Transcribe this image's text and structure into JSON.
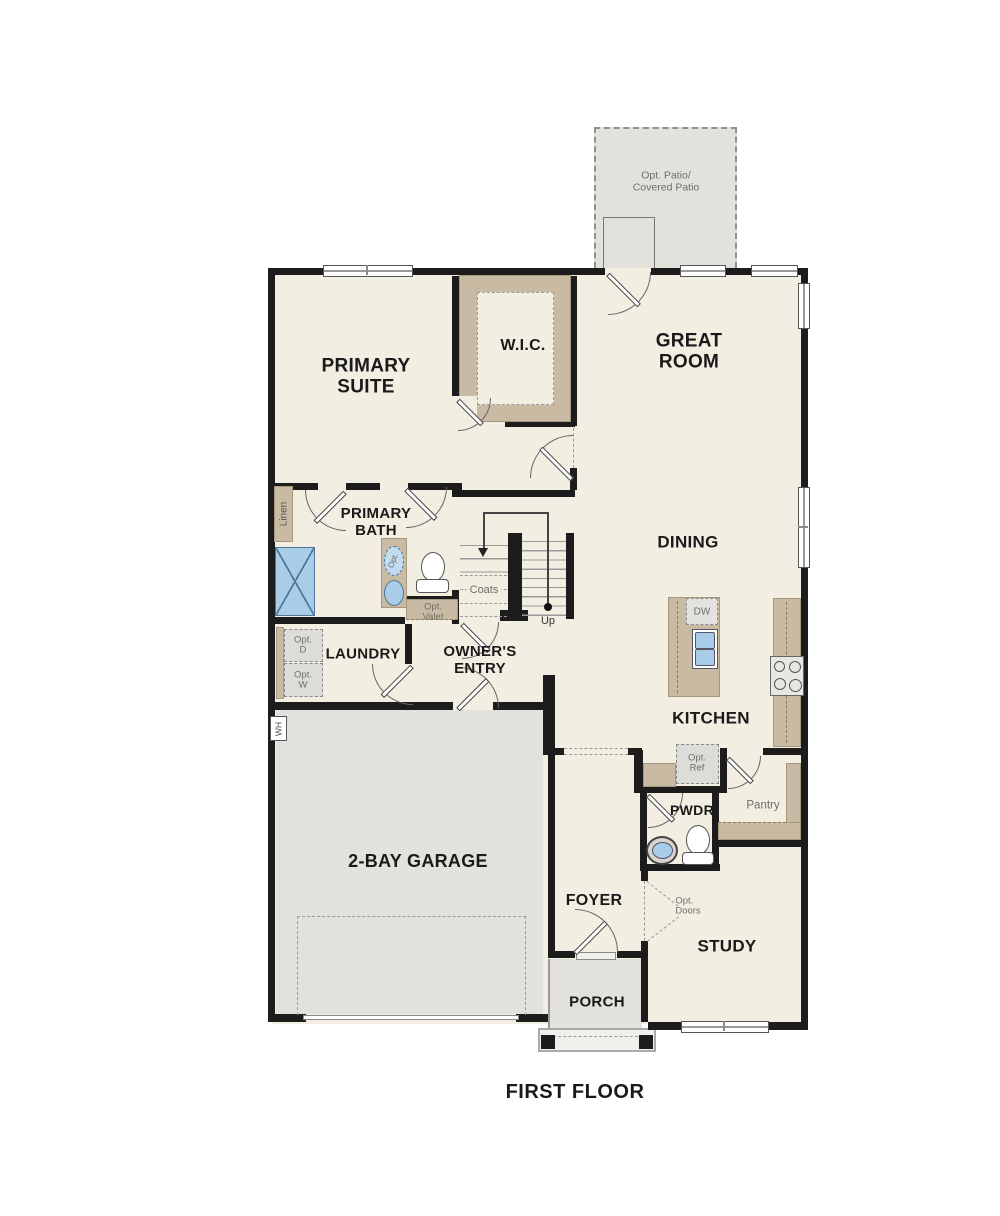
{
  "title": "FIRST FLOOR",
  "rooms": {
    "patio": "Opt. Patio/\nCovered Patio",
    "primary_suite": "PRIMARY\nSUITE",
    "wic": "W.I.C.",
    "great_room": "GREAT\nROOM",
    "dining": "DINING",
    "kitchen": "KITCHEN",
    "primary_bath": "PRIMARY\nBATH",
    "laundry": "LAUNDRY",
    "owners_entry": "OWNER'S\nENTRY",
    "garage": "2-BAY GARAGE",
    "pwdr": "PWDR",
    "pantry": "Pantry",
    "foyer": "FOYER",
    "study": "STUDY",
    "porch": "PORCH"
  },
  "annotations": {
    "linen": "Linen",
    "coats": "Coats",
    "up": "Up",
    "opt_valet": "Opt.\nValet",
    "opt_d": "Opt.\nD",
    "opt_w": "Opt.\nW",
    "opt_ref": "Opt.\nRef",
    "opt_doors": "Opt.\nDoors",
    "dw": "DW",
    "wh": "WH",
    "opt_fixture": "Opt."
  },
  "colors": {
    "wall": "#1c1c1c",
    "room": "#f3eee2",
    "slab": "#e3e1dc",
    "cabinet": "#c9bba3",
    "fixture": "#a9cde8",
    "appliance": "#dcdcd9",
    "line": "#666666",
    "label": "#1a1a1a",
    "label_gray": "#6f6e68"
  }
}
